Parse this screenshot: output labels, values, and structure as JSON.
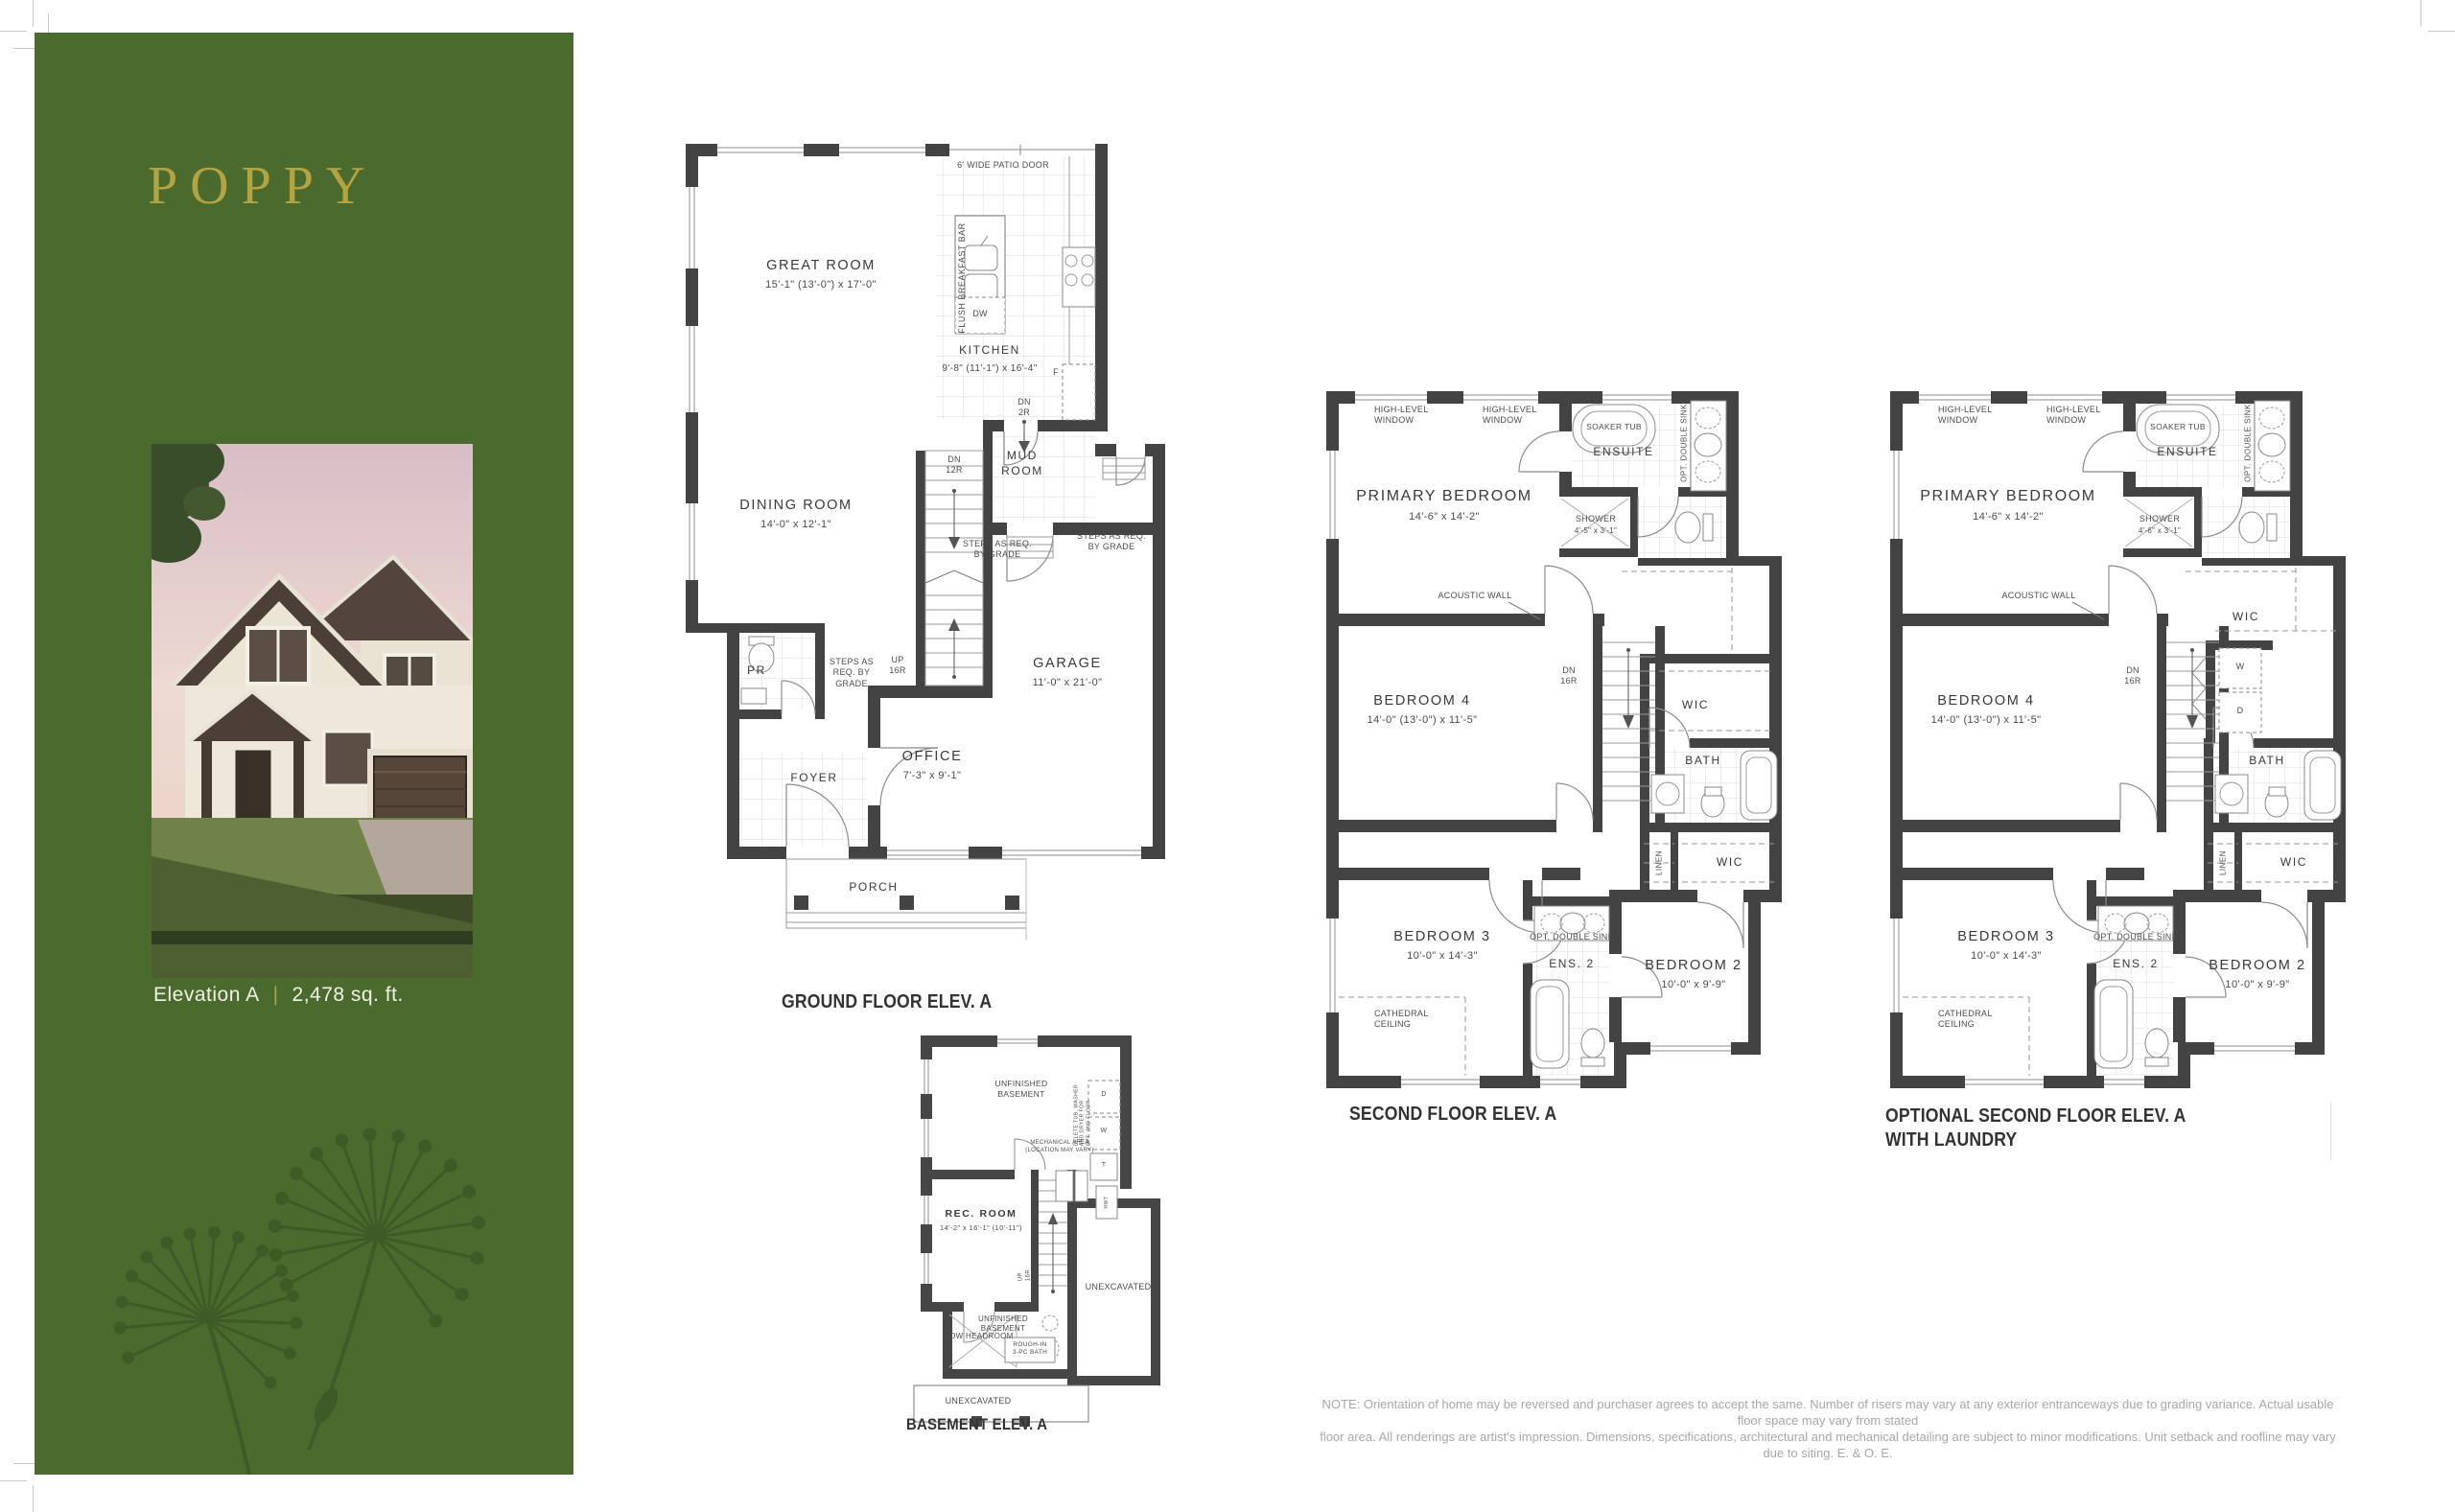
{
  "colors": {
    "page_bg": "#ffffff",
    "panel_green": "#4a6b2d",
    "dandelion_green": "#3e5a26",
    "title_gold": "#b4a341",
    "wall": "#434343"
  },
  "panel": {
    "title": "POPPY",
    "elevation_label": "Elevation A",
    "divider": "|",
    "sqft": "2,478 sq. ft."
  },
  "gf": {
    "caption": "GROUND FLOOR ELEV. A",
    "rooms": {
      "great": {
        "name": "GREAT ROOM",
        "dims": "15'-1\" (13'-0\")  x 17'-0\""
      },
      "kitchen": {
        "name": "KITCHEN",
        "dims": "9'-8\" (11'-1\")  x 16'-4\""
      },
      "dining": {
        "name": "DINING ROOM",
        "dims": "14'-0\"  x 12'-1\""
      },
      "mud": "MUD\nROOM",
      "garage": {
        "name": "GARAGE",
        "dims": "11'-0\"  x 21'-0\""
      },
      "office": {
        "name": "OFFICE",
        "dims": "7'-3\"  x 9'-1\""
      },
      "foyer": "FOYER",
      "porch": "PORCH",
      "pr": "PR"
    },
    "ann": {
      "patio": "6' WIDE PATIO DOOR",
      "bbar": "FLUSH BREAKFAST BAR",
      "dw": "DW",
      "fridge": "F",
      "dn2r": "DN\n2R",
      "dn12r": "DN\n12R",
      "up16r": "UP\n16R",
      "steps": "STEPS AS REQ.\nBY GRADE",
      "steps3": "STEPS AS\nREQ. BY\nGRADE"
    }
  },
  "sf": {
    "caption": "SECOND FLOOR ELEV. A",
    "rooms": {
      "primary": {
        "name": "PRIMARY BEDROOM",
        "dims": "14'-6\"  x 14'-2\""
      },
      "ensuite": "ENSUITE",
      "shower": {
        "name": "SHOWER",
        "dims": "4'-5\"  x  3'-1\""
      },
      "bed4": {
        "name": "BEDROOM 4",
        "dims": "14'-0\" (13'-0\")  x 11'-5\""
      },
      "bed3": {
        "name": "BEDROOM 3",
        "dims": "10'-0\"  x 14'-3\""
      },
      "bed2": {
        "name": "BEDROOM 2",
        "dims": "10'-0\"  x 9'-9\""
      },
      "ens2": "ENS. 2",
      "bath": "BATH",
      "wic": "WIC",
      "wic2": "WIC",
      "linen": "LINEN"
    },
    "ann": {
      "hlw": "HIGH-LEVEL\nWINDOW",
      "soaker": "SOAKER TUB",
      "optsink": "OPT. DOUBLE SINK",
      "acoustic": "ACOUSTIC WALL",
      "dn16r": "DN\n16R",
      "cathedral": "CATHEDRAL\nCEILING"
    }
  },
  "osf": {
    "caption": "OPTIONAL SECOND FLOOR ELEV. A\nWITH LAUNDRY",
    "rooms": {
      "primary": {
        "name": "PRIMARY BEDROOM",
        "dims": "14'-6\"  x 14'-2\""
      },
      "ensuite": "ENSUITE",
      "shower": {
        "name": "SHOWER",
        "dims": "4'-6\"  x  3'-1\""
      },
      "bed4": {
        "name": "BEDROOM 4",
        "dims": "14'-0\" (13'-0\")  x 11'-5\""
      },
      "bed3": {
        "name": "BEDROOM 3",
        "dims": "10'-0\"  x 14'-3\""
      },
      "bed2": {
        "name": "BEDROOM 2",
        "dims": "10'-0\"  x 9'-9\""
      },
      "ens2": "ENS. 2",
      "bath": "BATH",
      "wic": "WIC",
      "wic2": "WIC",
      "linen": "LINEN",
      "laundry_w": "W",
      "laundry_d": "D"
    },
    "ann": {
      "hlw": "HIGH-LEVEL\nWINDOW",
      "soaker": "SOAKER TUB",
      "optsink": "OPT. DOUBLE SINK",
      "acoustic": "ACOUSTIC WALL",
      "dn16r": "DN\n16R",
      "cathedral": "CATHEDRAL\nCEILING"
    }
  },
  "bsmt": {
    "caption": "BASEMENT ELEV. A",
    "rooms": {
      "unf": "UNFINISHED\nBASEMENT",
      "rec": {
        "name": "REC. ROOM",
        "dims": "14'-2\" x 16'-1\" (10'-11\")"
      },
      "unex": "UNEXCAVATED",
      "unf2": "UNFINISHED\nBASEMENT",
      "low": "LOW HEADROOM",
      "rough": "ROUGH-IN\n3-PC BATH",
      "unex2": "UNEXCAVATED"
    },
    "ann": {
      "mech": "MECHANICAL AREA\n(LOCATION MAY VARY)",
      "note": "DELETE TUB, WASHER\nAND DRYER FOR\nOPT. 2ND FLOOR",
      "d": "D",
      "w": "W",
      "t": "T",
      "hwt": "HWT",
      "up16r": "UP\n16R"
    }
  },
  "disclaimer": {
    "line1": "NOTE: Orientation of home may be reversed and purchaser agrees to accept the same. Number of risers may vary at any exterior entranceways due to grading variance. Actual usable floor space may vary from stated",
    "line2": "floor area. All renderings are artist's impression. Dimensions, specifications, architectural and mechanical detailing are subject to minor modifications. Unit setback and roofline may vary due to siting. E. & O. E."
  }
}
